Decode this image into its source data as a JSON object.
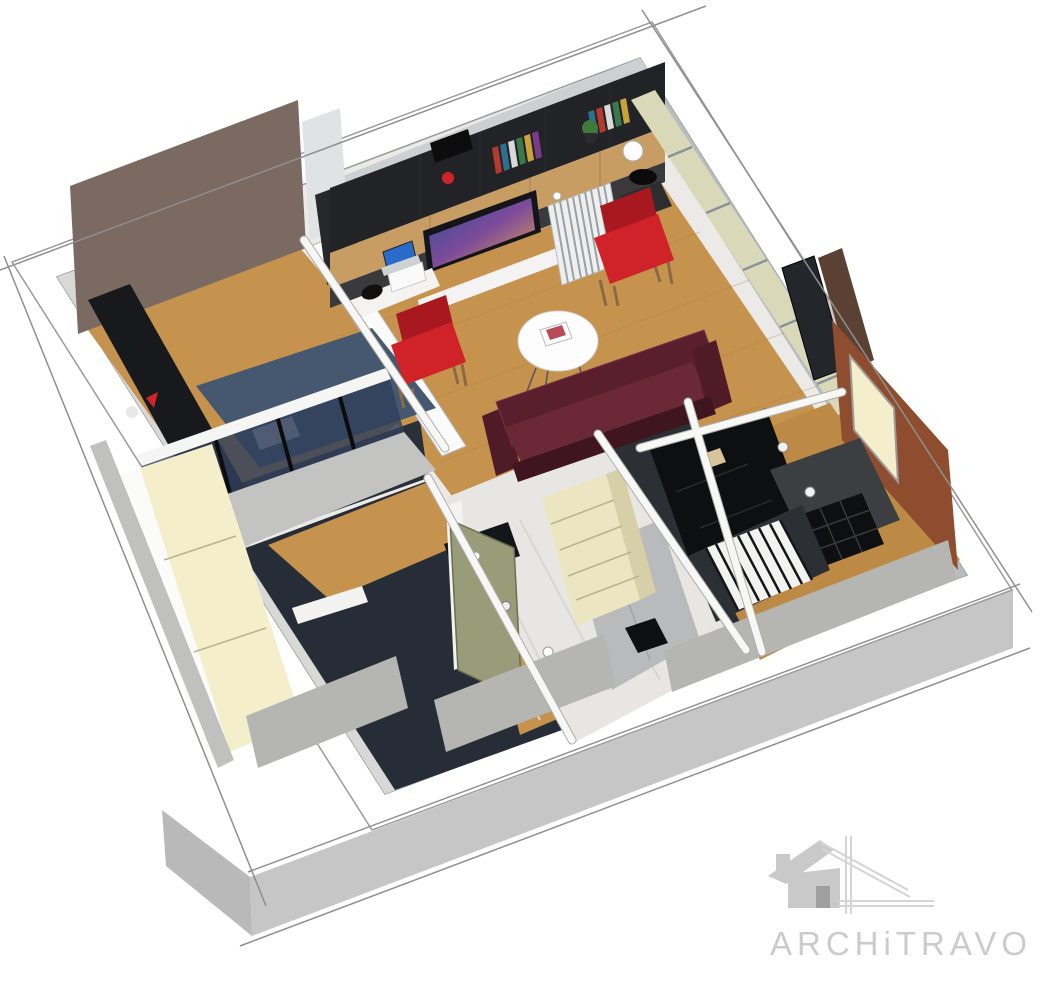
{
  "canvas": {
    "width": 1046,
    "height": 981,
    "background": "#ffffff"
  },
  "watermark": {
    "brand": "ARCHiTRAVO",
    "icon": "house-sketch-icon",
    "text_color": "#cbcbcb",
    "icon_color": "#c9c9c9"
  },
  "scene": {
    "type": "3d-floorplan-axonometric-cutaway",
    "style": "sketch-render",
    "rooms": [
      {
        "name": "bedroom",
        "floor": "wood",
        "features": [
          "brown-accent-wall",
          "bed-blue",
          "dark-wardrobe",
          "glass-partition",
          "cream-wardrobe"
        ]
      },
      {
        "name": "living-room",
        "floor": "wood",
        "features": [
          "tv-wall-unit",
          "bookshelves",
          "desk-laptop",
          "radiator",
          "red-armchair-left",
          "red-armchair-right",
          "coffee-table",
          "burgundy-sofa",
          "window-wall",
          "sphere-lamp",
          "pendant-lamp"
        ]
      },
      {
        "name": "dressing-room",
        "floor": "wood-navy",
        "features": [
          "dark-closet",
          "white-shelf"
        ]
      },
      {
        "name": "entry-hall",
        "floor": "marble-tile",
        "features": [
          "sage-door",
          "cream-shelf-unit",
          "spotlight-marks"
        ]
      },
      {
        "name": "bathroom",
        "floor": "dark",
        "features": [
          "shower-screen",
          "striped-mat",
          "black-fixture"
        ]
      },
      {
        "name": "kitchen",
        "floor": "wood",
        "features": [
          "rust-wall",
          "kitchen-window",
          "charcoal-island",
          "black-grid-stove",
          "striped-mat",
          "black-closet"
        ]
      }
    ]
  },
  "palette": {
    "page_bg": "#ffffff",
    "plinth": "#c6c6c6",
    "plinth_dark": "#b9b9b9",
    "wall_white": "#ffffff",
    "base": "#eceae7",
    "inner_gray": "#b9bcbe",
    "inner_light": "#d8d8d6",
    "inner_nw": "#cdd0d2",
    "wood": "#c6934e",
    "wood_kitchen": "#bd8a45",
    "tile": "#e8e6e2",
    "brown_wall": "#7b6a61",
    "rust_wall": "#8f4d30",
    "rust_dark": "#7c4024",
    "walnut": "#5b4133",
    "navy_floor": "#272d36",
    "dark_wall": "#2a3038",
    "dark_wardrobe": "#17191d",
    "black": "#0e0f11",
    "charcoal": "#3b3f42",
    "charcoal_dark": "#2c2f33",
    "shelf_black": "#222326",
    "unit_side": "#26282b",
    "unit_base": "#3a3a3c",
    "cream": "#f4eecb",
    "cream_shelf": "#ece5c2",
    "cream_side": "#d6cfa8",
    "board": "#d8c49a",
    "sage": "#999c78",
    "door_frame": "#f2f2f0",
    "glass_green": "#d9d9ba",
    "glass_dark": "#31405a",
    "window_pale": "#dfe3e4",
    "burgundy": "#6b2836",
    "burgundy_deep": "#5a1f2c",
    "burgundy_arm": "#4f1b27",
    "burgundy_base": "#3f1520",
    "red": "#cf2329",
    "red_dark": "#a8181f",
    "bed_blue": "#46586f",
    "pillow": "#d4d7da",
    "rail": "#f5f5f3",
    "low_wall": "#c3c3c1",
    "shower": "#b9babb",
    "cut_wall": "#b5b5b2",
    "cut_wall_light": "#c0c0be",
    "wood_cab": "#c79d63",
    "off_white": "#f4f3f1",
    "white_soft": "#fbfbfb",
    "tv_frame": "#141519",
    "tv_blue": "#2b4f93",
    "tv_purple": "#7c4b9b",
    "tv_orange": "#e8a04a",
    "laptop": "#2a6ac8",
    "laptop_base": "#cfd2d4",
    "plant": "#3f7a3a",
    "pot": "#2b2b2b",
    "gray_box": "#c9c9c7",
    "stool": "#2b2d2f",
    "book_red": "#b43a2e",
    "book_blue": "#2e6e8e",
    "book_white": "#d9d9d9",
    "book_green": "#3a7a4a",
    "book_yellow": "#c8a23a",
    "book_purple": "#7a3a8a",
    "logo": "#c9c9c9",
    "logo_door": "#9f9f9f",
    "logo_text": "#cbcbcb"
  }
}
